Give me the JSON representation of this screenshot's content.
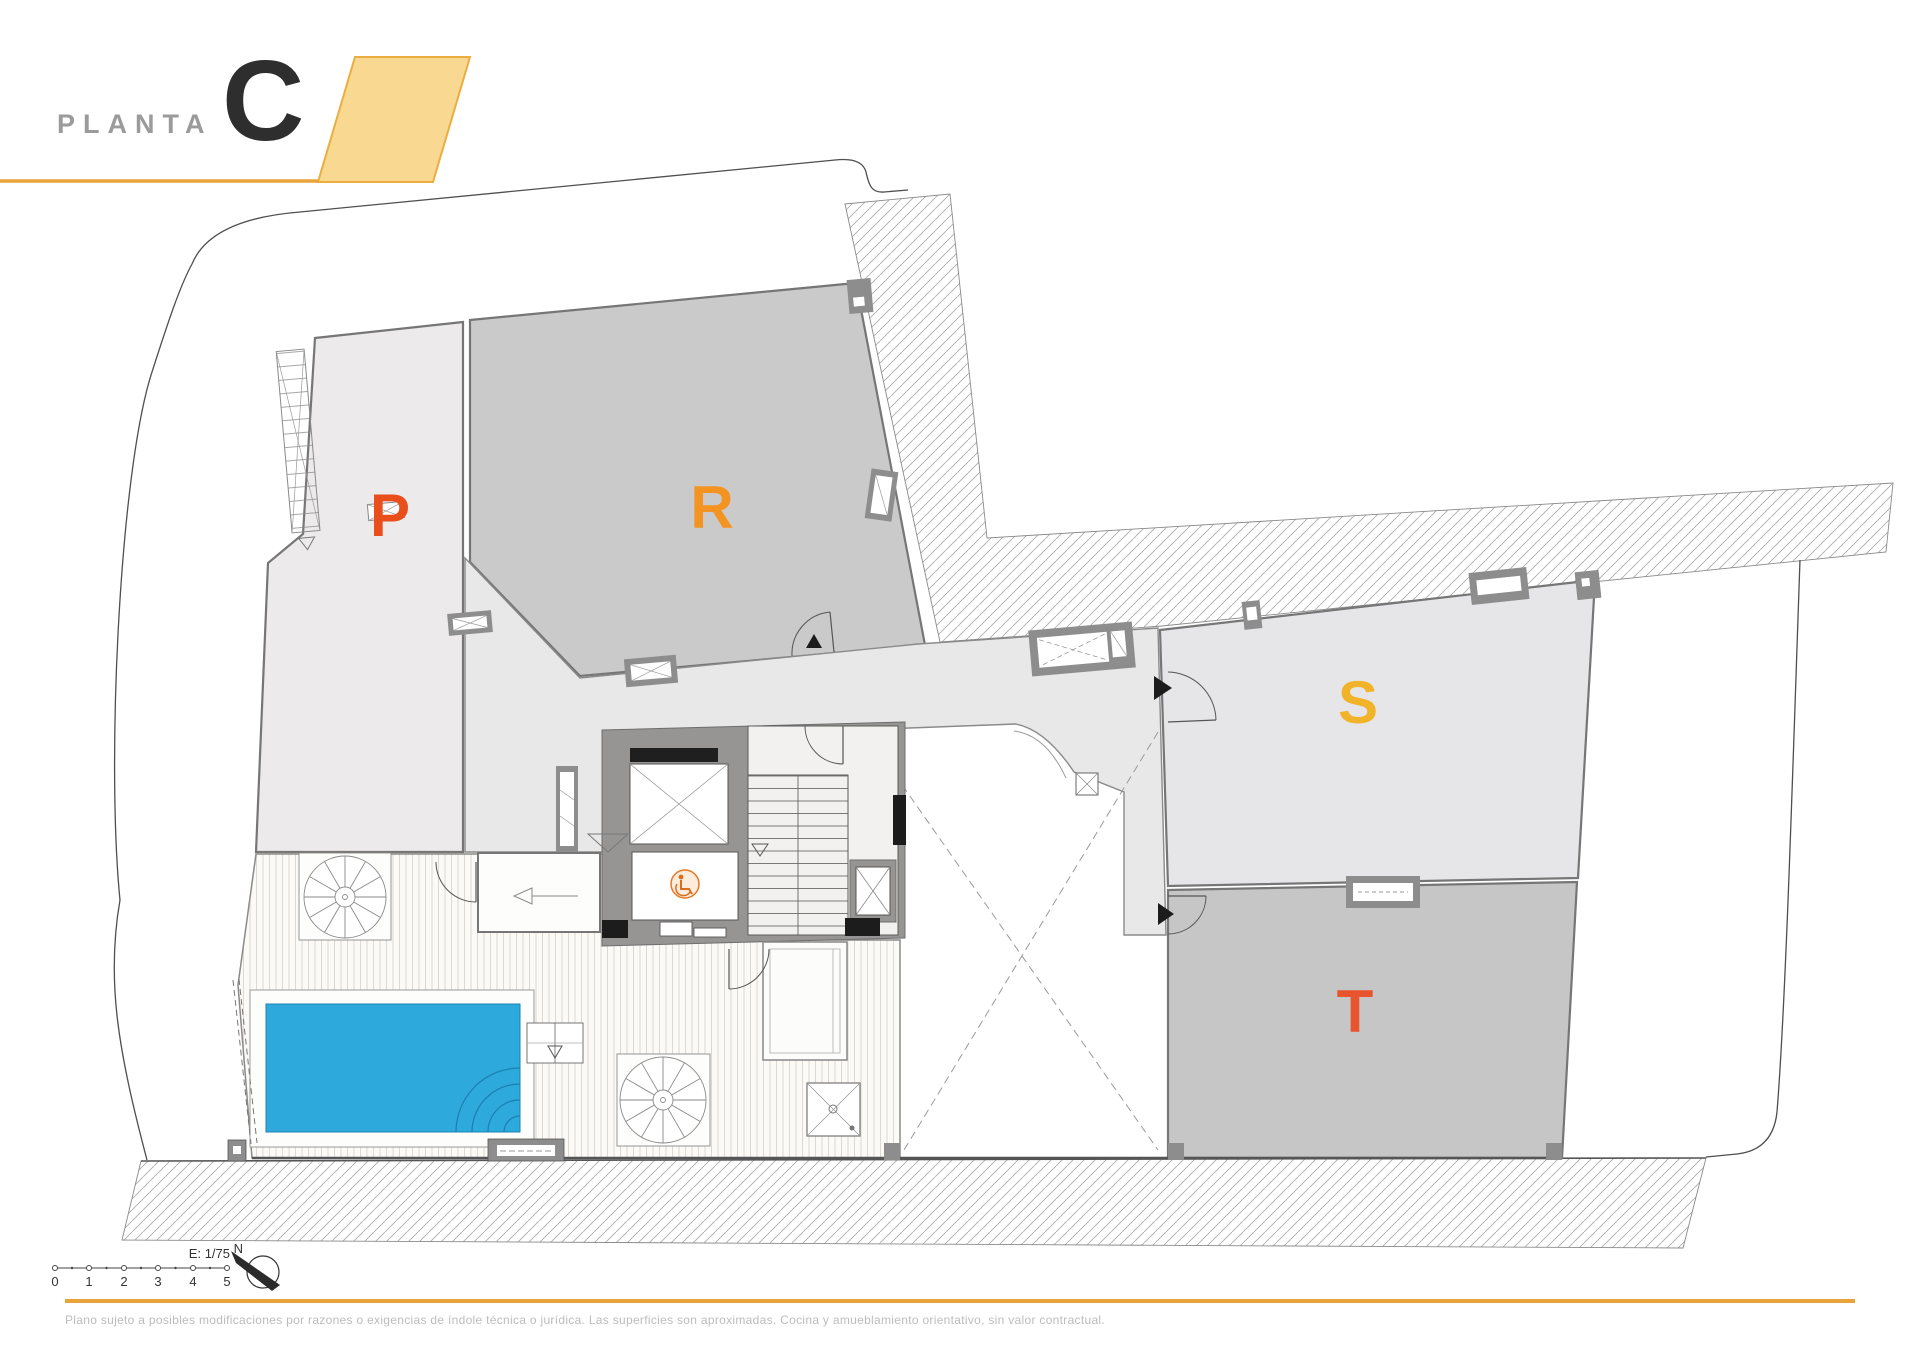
{
  "header": {
    "floor_label": "PLANTA",
    "floor_letter": "C"
  },
  "zones": {
    "p": {
      "label": "P",
      "color": "#E94E1B"
    },
    "r": {
      "label": "R",
      "color": "#F39422"
    },
    "s": {
      "label": "S",
      "color": "#F0B32A"
    },
    "t": {
      "label": "T",
      "color": "#E8542E"
    }
  },
  "scalebar": {
    "scale_label": "E: 1/75",
    "ticks": [
      "0",
      "1",
      "2",
      "3",
      "4",
      "5"
    ]
  },
  "compass": {
    "north_label": "N"
  },
  "footer": {
    "disclaimer": "Plano sujeto a posibles modificaciones por razones o exigencias de índole técnica o jurídica. Las superficies son aproximadas. Cocina y amueblamiento orientativo, sin valor contractual."
  },
  "colors": {
    "accent_gold_line": "#E8A33B",
    "header_parallelogram": "#F9D992",
    "header_label_gray": "#9C9B9B",
    "floor_letter_dark": "#2E2E2E",
    "pool_water": "#2EA9DB",
    "zone_p_fill": "#ECEAEA",
    "zone_r_fill": "#CBCACA",
    "zone_s_fill": "#E6E5E8",
    "zone_t_fill": "#C7C6C6",
    "corridor_fill": "#E9E8E8",
    "wall_gray": "#8E8D8D",
    "footer_text_gray": "#BCBCBC",
    "accessibility_icon_orange": "#E87722"
  }
}
